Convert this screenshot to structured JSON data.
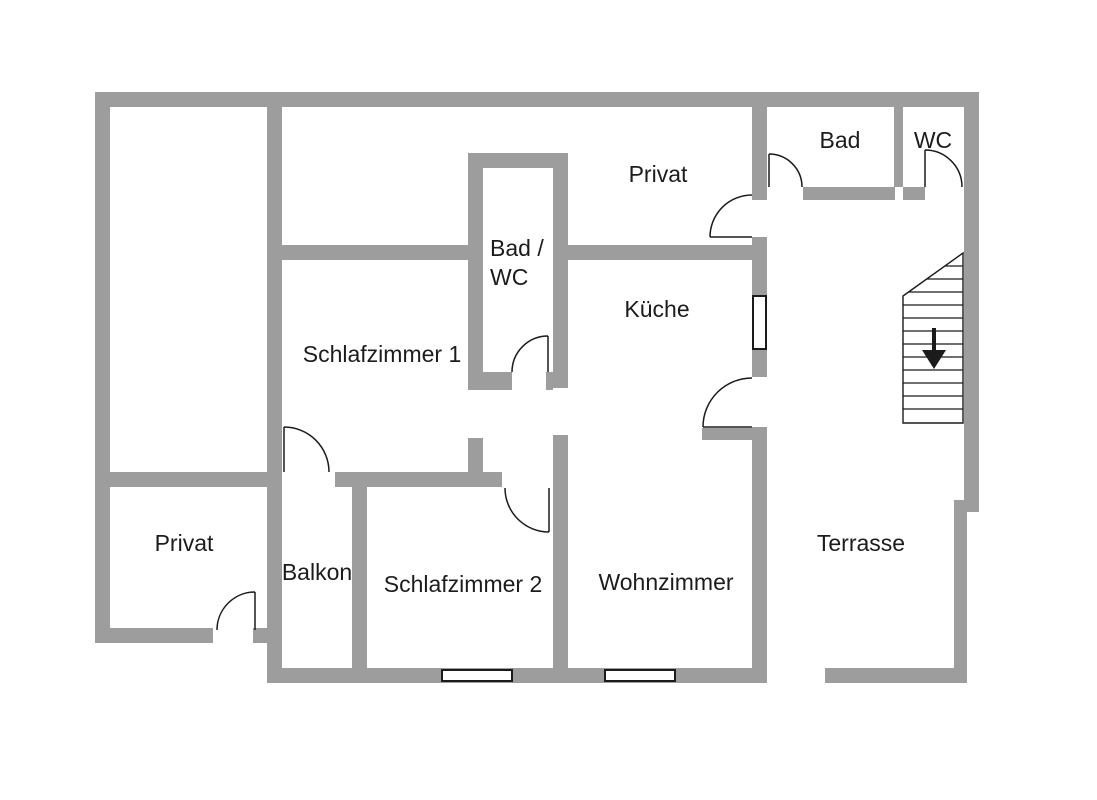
{
  "plan": {
    "title": "Grundriss Obergeschoss",
    "colors": {
      "wall": "#9d9d9d",
      "line": "#1b1b1b",
      "text": "#1c1c1c",
      "background": "#ffffff",
      "window_fill": "#ffffff"
    },
    "rooms": {
      "top_privat": {
        "label": "Privat"
      },
      "bad": {
        "label": "Bad"
      },
      "wc": {
        "label": "WC"
      },
      "bad_wc": {
        "label_line1": "Bad /",
        "label_line2": "WC"
      },
      "kueche": {
        "label": "Küche"
      },
      "schlafzimmer1": {
        "label": "Schlafzimmer 1"
      },
      "schlafzimmer2": {
        "label": "Schlafzimmer 2"
      },
      "wohnzimmer": {
        "label": "Wohnzimmer"
      },
      "balkon": {
        "label": "Balkon"
      },
      "privat_unten": {
        "label": "Privat"
      },
      "terrasse": {
        "label": "Terrasse"
      }
    },
    "stairs": {
      "icon": "arrow-down-icon",
      "direction": "down"
    }
  }
}
